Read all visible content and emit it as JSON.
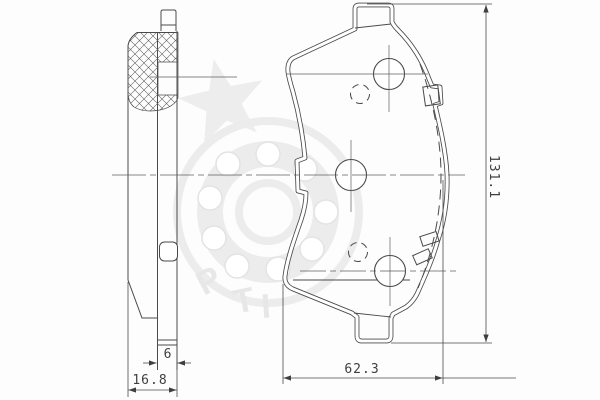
{
  "colors": {
    "line": "#4a4a4a",
    "centerline": "#5f5f5f",
    "watermark": "#ececec",
    "background": "#fdfdfd"
  },
  "drawing": {
    "dimensions": {
      "backplate_thickness": "6",
      "total_thickness": "16.8",
      "width": "62.3",
      "height": "131.1"
    },
    "watermark": {
      "shapes": [
        "star-icon",
        "bearing-ring-icon"
      ],
      "letters": [
        "P",
        "T",
        "I"
      ]
    }
  }
}
